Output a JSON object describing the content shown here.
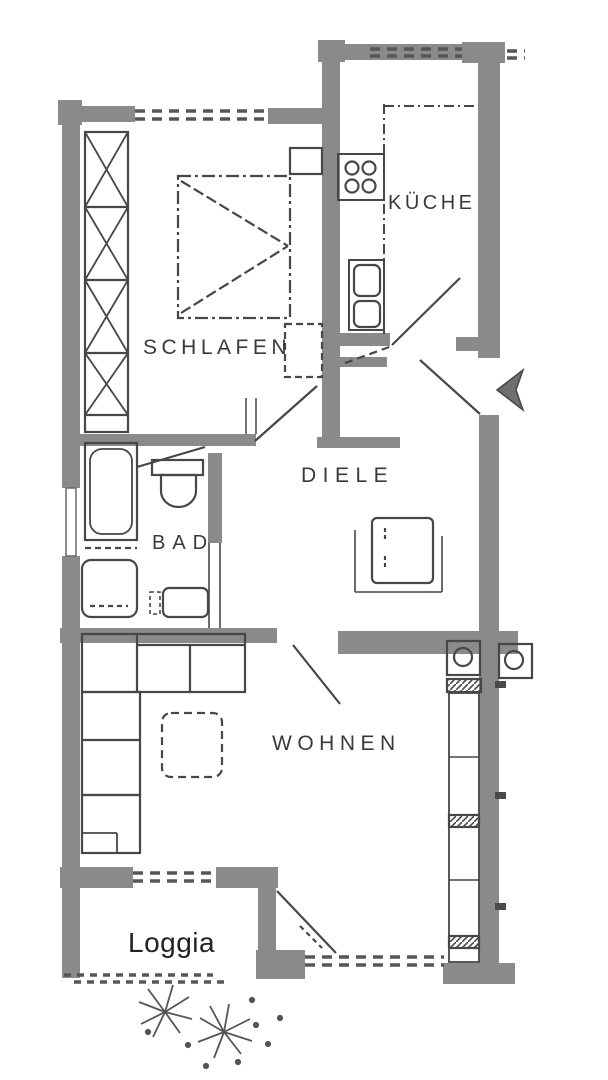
{
  "plan": {
    "type": "apartment-floor-plan",
    "labels": {
      "bedroom": "SCHLAFEN",
      "kitchen": "KÜCHE",
      "hallway": "DIELE",
      "bathroom": "BAD",
      "living": "WOHNEN",
      "loggia": "Loggia"
    },
    "colors": {
      "wall": "#8a8a8a",
      "line": "#474747",
      "dash": "#565656",
      "label": "#3a3a3a",
      "loggia_label": "#222222",
      "background": "#ffffff"
    },
    "icons": {
      "entrance": "entrance-arrow-icon",
      "stove": "stove-burners-icon",
      "sink": "double-sink-icon",
      "toilet": "toilet-icon",
      "bathtub": "bathtub-icon",
      "washbasin": "washbasin-icon",
      "washer": "washing-machine-icon",
      "plants": "shrub-sketch-icon"
    }
  }
}
